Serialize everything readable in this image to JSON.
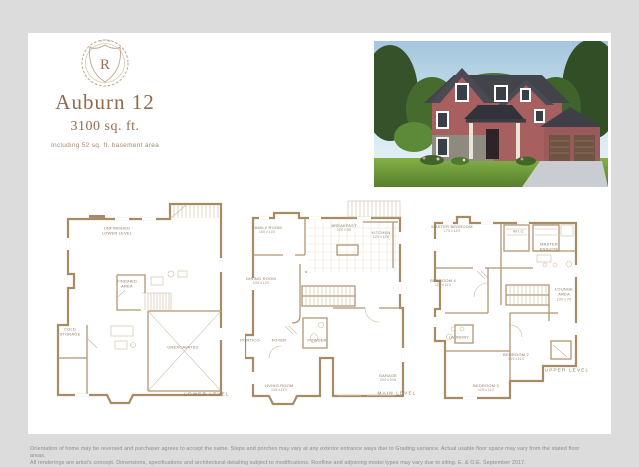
{
  "brand": {
    "logo_letter": "R"
  },
  "header": {
    "title": "Auburn 12",
    "sqft": "3100 sq. ft.",
    "note": "Including 52 sq. ft. basement area"
  },
  "plans": [
    {
      "name": "LOWER LEVEL",
      "rooms": {
        "unfinished": "UNFINISHED\nLOWER LEVEL",
        "finished": "FINISHED\nAREA",
        "cold": "COLD\nSTORAGE",
        "unexcavated": "UNEXCAVATED"
      }
    },
    {
      "name": "MAIN LEVEL",
      "rooms": {
        "family": "FAMILY ROOM",
        "family_dims": "18'0 x 13'0",
        "breakfast": "BREAKFAST",
        "breakfast_dims": "12'0 x 9'6",
        "kitchen": "KITCHEN",
        "kitchen_dims": "12'0 x 12'6",
        "dining": "DINING ROOM",
        "dining_dims": "13'6 x 12'0",
        "powder": "POWDER",
        "portico": "PORTICO",
        "foyer": "FOYER",
        "living": "LIVING ROOM",
        "living_dims": "13'6 x 11'0",
        "garage": "GARAGE",
        "garage_dims": "20'0 x 20'6"
      }
    },
    {
      "name": "UPPER LEVEL",
      "rooms": {
        "master": "MASTER BEDROOM",
        "master_dims": "17'0 x 14'0",
        "wic": "W.I.C.",
        "ensuite": "MASTER\nENSUITE",
        "bed4": "BEDROOM 4",
        "bed4_dims": "12'0 x 11'6",
        "lounge": "LOUNGE\nAREA",
        "lounge_dims": "10'0 x 7'6",
        "laundry": "LAUNDRY",
        "bed2": "BEDROOM 2",
        "bed2_dims": "14'6 x 11'0",
        "bed3": "BEDROOM 3",
        "bed3_dims": "12'6 x 11'0"
      }
    }
  ],
  "disclaimer": {
    "line1": "Orientation of home may be reversed and purchaser agrees to accept the same. Steps and porches may vary at any exterior entrance ways due to Grading variance. Actual usable floor space may vary from the stated floor areas.",
    "line2": "All renderings are artist's concept. Dimensions, specifications and architectural detailing subject to modifications.  Roofline and adjoining model types may vary due to siting. E. & O.E. September 2017."
  },
  "colors": {
    "accent": "#8f6b4e",
    "wall": "#a88a64",
    "page_bg": "#dcdcdc"
  }
}
